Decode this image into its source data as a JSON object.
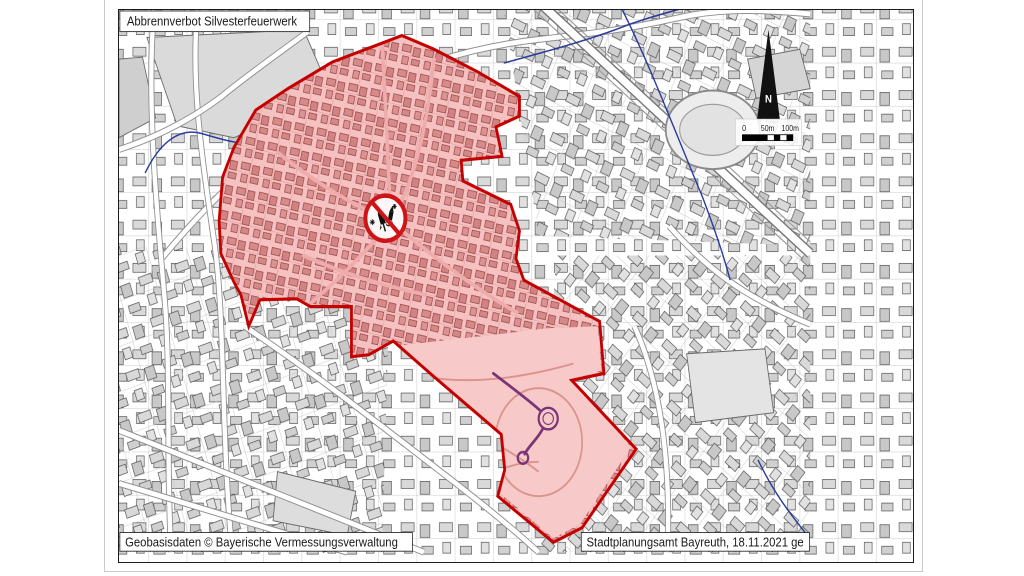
{
  "page": {
    "title_box": "Abbrennverbot Silvesterfeuerwerk",
    "credit_left": "Geobasisdaten © Bayerische Vermessungsverwaltung",
    "credit_right": "Stadtplanungsamt Bayreuth, 18.11.2021 ge"
  },
  "map": {
    "north_label": "N",
    "scale": {
      "tick0": "0",
      "tick50": "50m",
      "tick100": "100m"
    },
    "icon": "no-fireworks-prohibition-sign",
    "colors": {
      "zone_fill": "#e84c4c",
      "zone_border": "#c40000",
      "prohibition_red": "#d01317",
      "water_blue": "#23349b",
      "pond_purple": "#4a2d8a",
      "building_gray": "#d6d6d6",
      "north_arrow_black": "#111111"
    }
  }
}
